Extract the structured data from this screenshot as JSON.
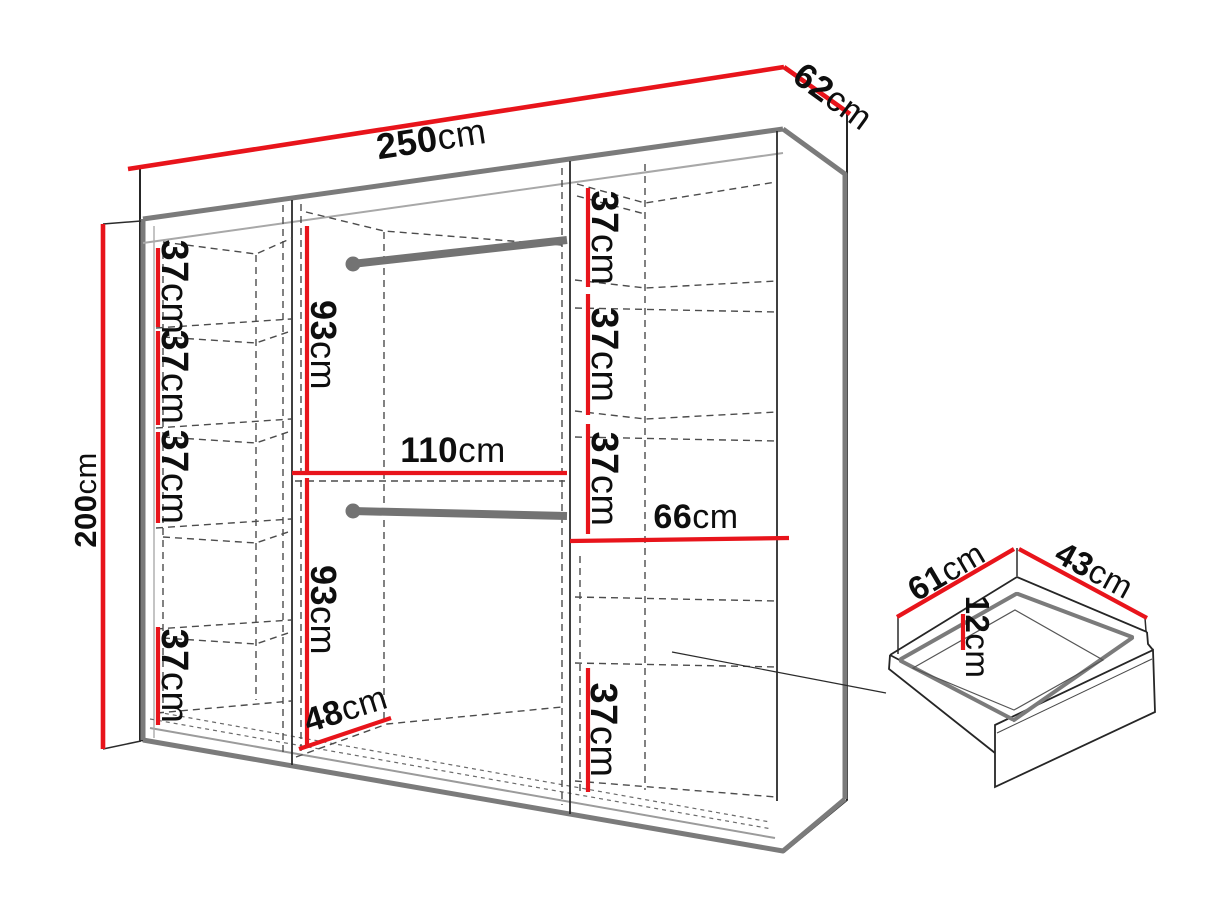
{
  "diagram": {
    "kind": "furniture-dimension-diagram",
    "subject": "wardrobe-with-drawer-detail"
  },
  "colors": {
    "dimension_red": "#e8141b",
    "carcass_gray": "#7b7b7b",
    "rod_gray": "#737373",
    "outline_dark": "#262626",
    "dash_gray": "#4c4c4c",
    "thin_gray": "#a0a0a0",
    "text": "#0e0e0e"
  },
  "wardrobe": {
    "overall": {
      "width": {
        "v": "250",
        "u": "cm"
      },
      "depth": {
        "v": "62",
        "u": "cm"
      },
      "height": {
        "v": "200",
        "u": "cm"
      }
    },
    "left_column": {
      "gaps": [
        {
          "v": "37",
          "u": "cm"
        },
        {
          "v": "37",
          "u": "cm"
        },
        {
          "v": "37",
          "u": "cm"
        },
        {
          "v": "37",
          "u": "cm"
        }
      ]
    },
    "middle_section": {
      "upper_height": {
        "v": "93",
        "u": "cm"
      },
      "lower_height": {
        "v": "93",
        "u": "cm"
      },
      "width": {
        "v": "110",
        "u": "cm"
      },
      "floor_depth": {
        "v": "48",
        "u": "cm"
      }
    },
    "right_column": {
      "gaps": [
        {
          "v": "37",
          "u": "cm"
        },
        {
          "v": "37",
          "u": "cm"
        },
        {
          "v": "37",
          "u": "cm"
        },
        {
          "v": "37",
          "u": "cm"
        }
      ],
      "shelf_width": {
        "v": "66",
        "u": "cm"
      }
    }
  },
  "drawer": {
    "width": {
      "v": "61",
      "u": "cm"
    },
    "depth": {
      "v": "43",
      "u": "cm"
    },
    "height": {
      "v": "12",
      "u": "cm"
    }
  }
}
